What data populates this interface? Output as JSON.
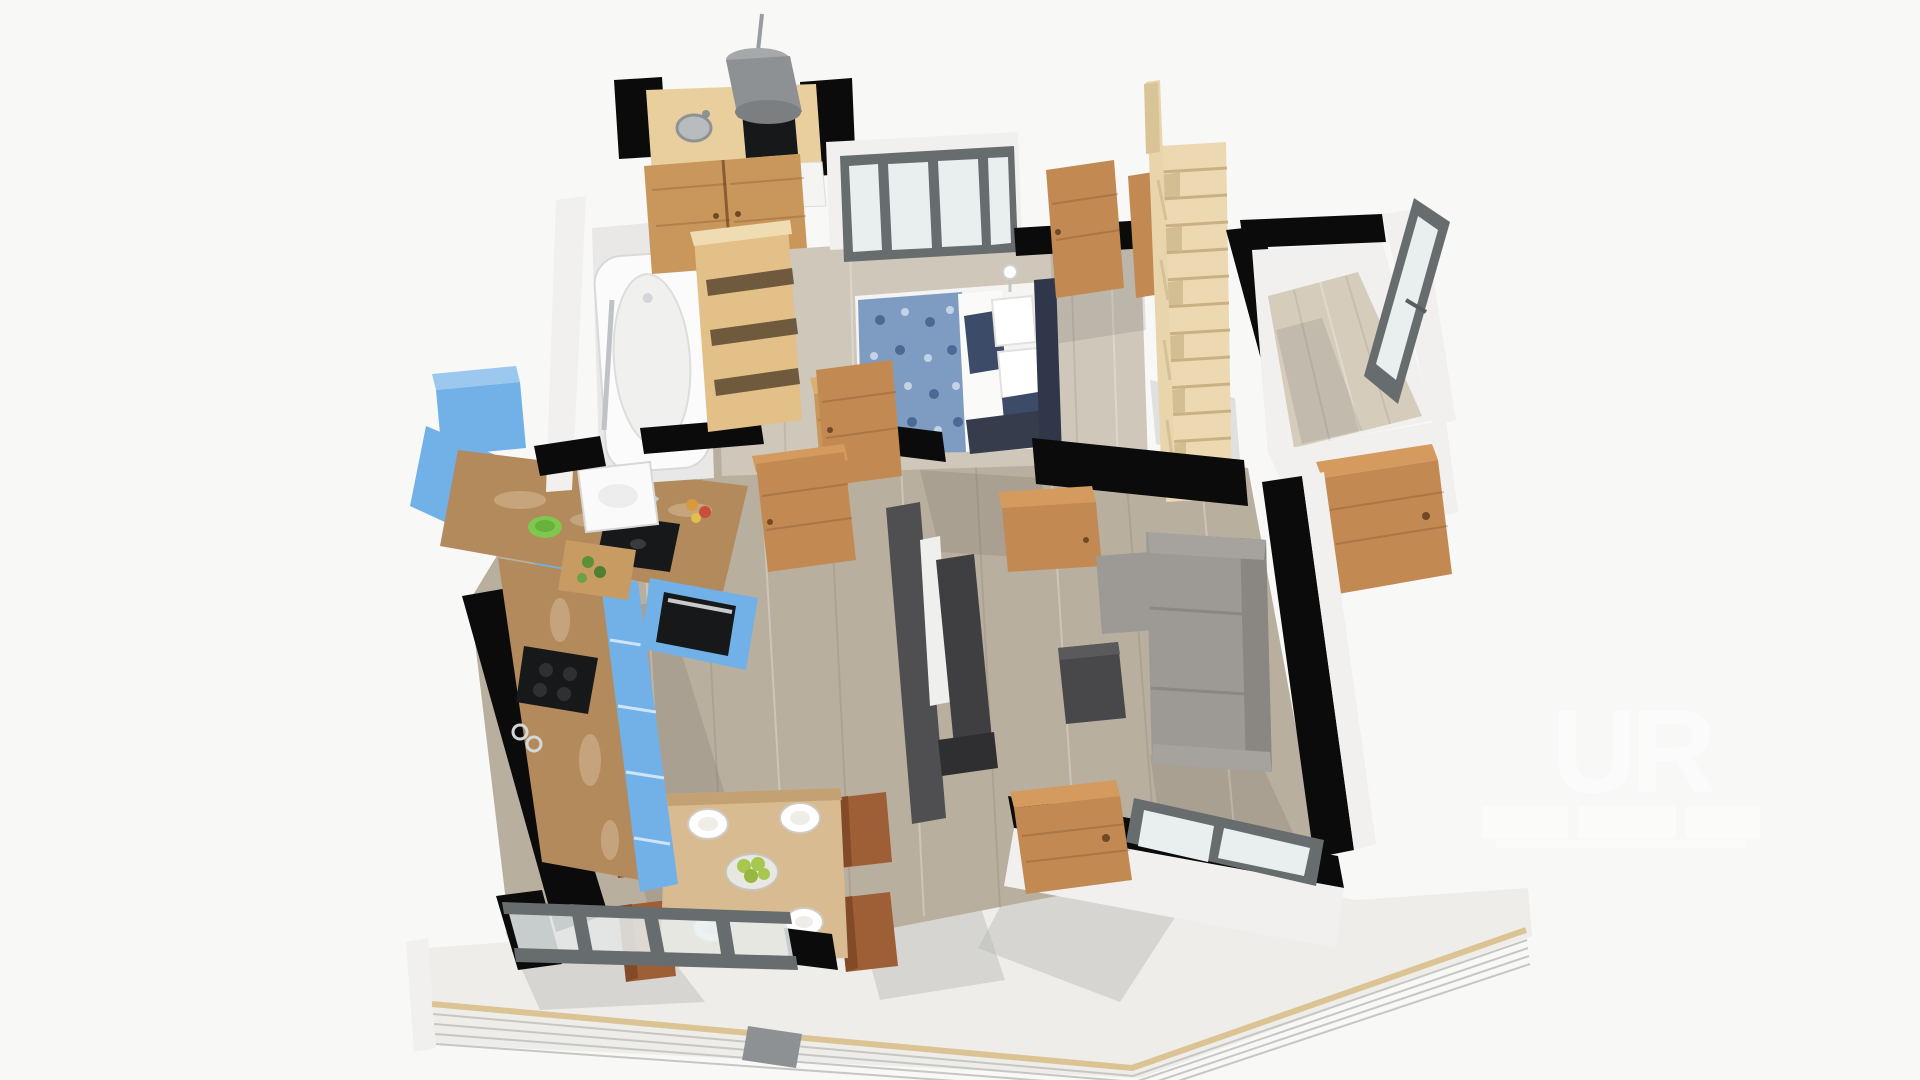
{
  "meta": {
    "description": "3D rendered isometric floor-plan (dollhouse view) of an apartment",
    "canvas": {
      "width": 1920,
      "height": 1080
    },
    "background": "#f8f8f7"
  },
  "watermark": {
    "logo_text": "UR"
  },
  "palette": {
    "wall": "#0b0b0b",
    "wallWhite": "#f1f0ee",
    "floorBedroom": "#cfc7b9",
    "floorLiving": "#b9af9f",
    "floorEntry": "#d5ccbc",
    "terraceFloor": "#eeede9",
    "stairsWood": "#ecd9b2",
    "railWood": "#e8d5ac",
    "doorWood": "#c28a52",
    "wardrobeWood": "#c9975c",
    "shelfWood": "#e2c088",
    "counterWood": "#e9cf9e",
    "tableWood": "#d8bb90",
    "chairBrown": "#9f5f36",
    "cabinetBlue": "#72b1e8",
    "cabinetBlueLight": "#9cc8f0",
    "marble": "#b28a5c",
    "applianceBlack": "#17181a",
    "sofaGray": "#9d9a96",
    "sofaGrayDark": "#8a8783",
    "coffeeTable": "#48484a",
    "tvWall": "#4f4f52",
    "windowFrame": "#676c6f",
    "glass": "#e9eeef",
    "tubWhite": "#fbfbfb",
    "beddingWhite": "#f5f4f2",
    "blanketBlue": "#7e9cc2",
    "pillowNavy": "#3c4c68",
    "headboardDark": "#30374a",
    "hoodGray": "#8e9194",
    "greenBowl": "#7ec850",
    "apples": "#a8c74f",
    "watermarkWhite": "#ffffff"
  },
  "scene": {
    "rooms": [
      {
        "name": "utility-kitchenette",
        "furniture": [
          "wood-countertop",
          "round-sink",
          "induction-hob",
          "range-hood",
          "white-drawer-front",
          "wardrobe-double-doors"
        ]
      },
      {
        "name": "bathroom",
        "furniture": [
          "bathtub",
          "grab-bar",
          "washbasin"
        ]
      },
      {
        "name": "bedroom",
        "furniture": [
          "double-bed",
          "blue-floral-blanket",
          "white-duvet",
          "navy-pillows",
          "headboard",
          "nightstand",
          "table-lamp",
          "four-pane-window",
          "interior-doors"
        ]
      },
      {
        "name": "staircase",
        "furniture": [
          "wooden-straight-stairs",
          "handrail",
          "balusters"
        ]
      },
      {
        "name": "entry-hall",
        "furniture": [
          "open-casement-window",
          "entry-door"
        ]
      },
      {
        "name": "kitchen",
        "furniture": [
          "blue-l-shaped-cabinets",
          "blue-wall-cabinet",
          "marble-countertop",
          "black-sink",
          "faucet",
          "cutting-board",
          "green-bowl",
          "induction-cooktop",
          "built-in-oven",
          "fruit"
        ]
      },
      {
        "name": "dining-room",
        "furniture": [
          "wooden-dining-table",
          "four-brown-chairs",
          "place-settings",
          "apple-bowl",
          "sliding-glass-doors"
        ]
      },
      {
        "name": "living-room",
        "furniture": [
          "gray-corner-sofa",
          "dark-coffee-table",
          "media-partition-wall",
          "interior-door",
          "bottom-window"
        ]
      },
      {
        "name": "terrace",
        "furniture": [
          "cable-railing",
          "wood-top-rail",
          "access-step"
        ]
      }
    ]
  }
}
